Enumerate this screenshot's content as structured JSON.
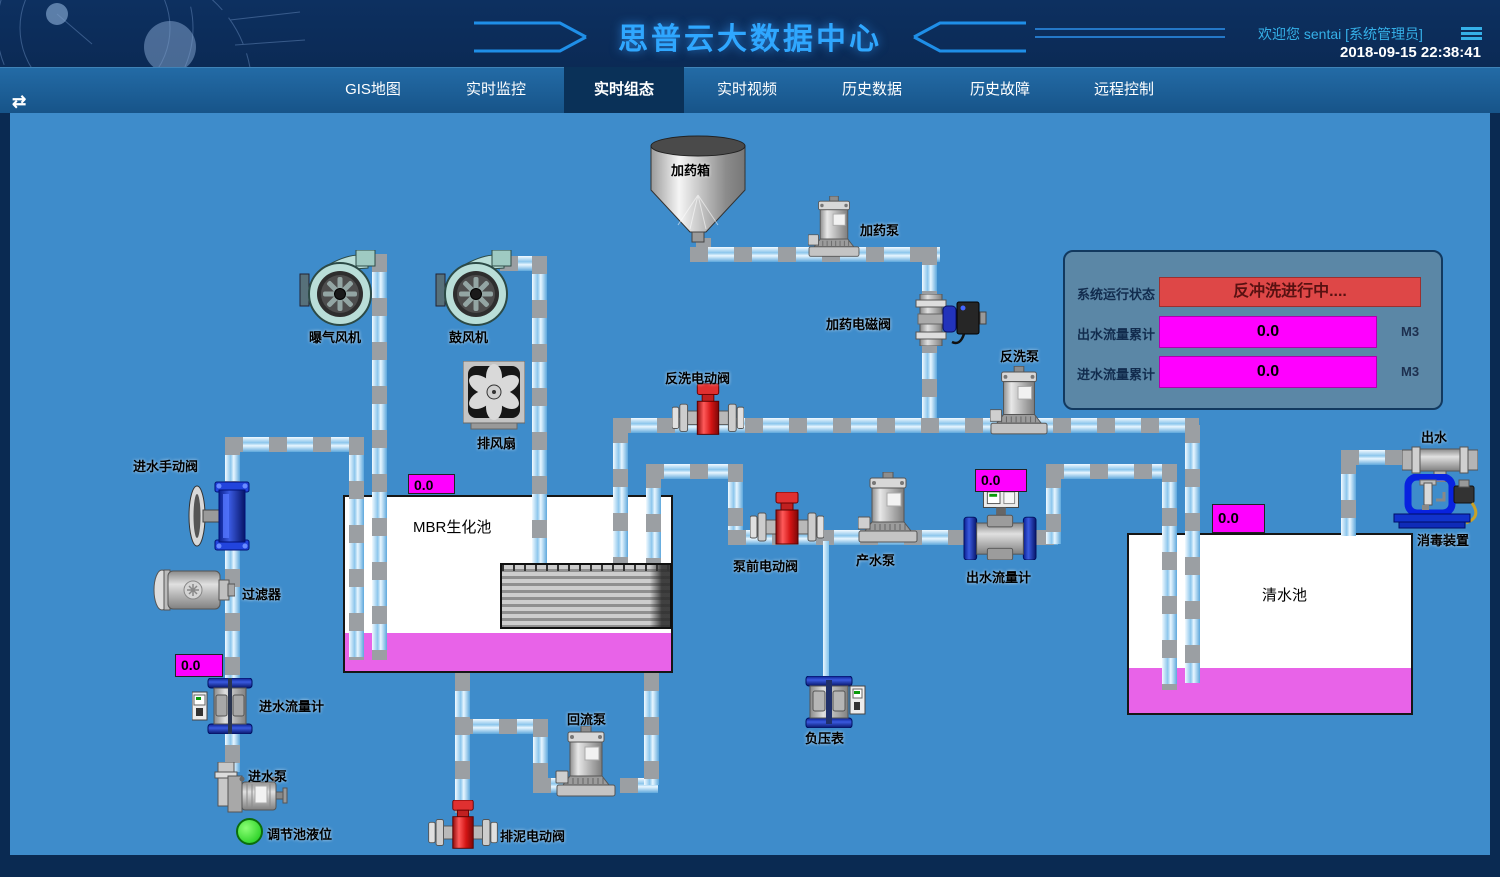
{
  "header": {
    "title": "思普云大数据中心",
    "welcome": "欢迎您  sentai [系统管理员]",
    "datetime": "2018-09-15 22:38:41",
    "collapse_glyph": "⇄"
  },
  "nav": {
    "tabs": [
      {
        "label": "GIS地图"
      },
      {
        "label": "实时监控"
      },
      {
        "label": "实时组态"
      },
      {
        "label": "实时视频"
      },
      {
        "label": "历史数据"
      },
      {
        "label": "历史故障"
      },
      {
        "label": "远程控制"
      }
    ],
    "active": "实时组态"
  },
  "status_panel": {
    "system_status_label": "系统运行状态",
    "system_status_value": "反冲洗进行中....",
    "outlet_total_label": "出水流量累计",
    "outlet_total_value": "0.0",
    "outlet_total_unit": "M3",
    "inlet_total_label": "进水流量累计",
    "inlet_total_value": "0.0",
    "inlet_total_unit": "M3"
  },
  "labels": {
    "aeration_blower": "曝气风机",
    "air_blower": "鼓风机",
    "exhaust_fan": "排风扇",
    "dosing_tank": "加药箱",
    "dosing_pump": "加药泵",
    "dosing_solenoid_valve": "加药电磁阀",
    "backwash_valve": "反洗电动阀",
    "backwash_pump": "反洗泵",
    "inlet_manual_valve": "进水手动阀",
    "filter": "过滤器",
    "mbr_tank": "MBR生化池",
    "prepump_valve": "泵前电动阀",
    "product_pump": "产水泵",
    "outlet_flowmeter": "出水流量计",
    "inlet_flowmeter": "进水流量计",
    "inlet_pump": "进水泵",
    "regulating_tank_level": "调节池液位",
    "return_pump": "回流泵",
    "sludge_valve": "排泥电动阀",
    "vacuum_gauge": "负压表",
    "clean_water_tank": "清水池",
    "outlet": "出水",
    "disinfection_device": "消毒装置"
  },
  "readouts": {
    "mbr_level": "0.0",
    "outlet_flow": "0.0",
    "clean_tank_level": "0.0",
    "inlet_flow": "0.0"
  },
  "colors": {
    "header_bg": "#0c2c5a",
    "nav_bg": "#1b5f98",
    "nav_active_bg": "#0a3158",
    "canvas_bg": "#3e8ccb",
    "accent": "#2fa7ff",
    "alarm_red": "#de4747",
    "readout_magenta": "#ff00ff",
    "liquid_magenta": "#e863e8",
    "panel_bg": "#5b87a6",
    "level_ok_green": "#22dd22"
  }
}
